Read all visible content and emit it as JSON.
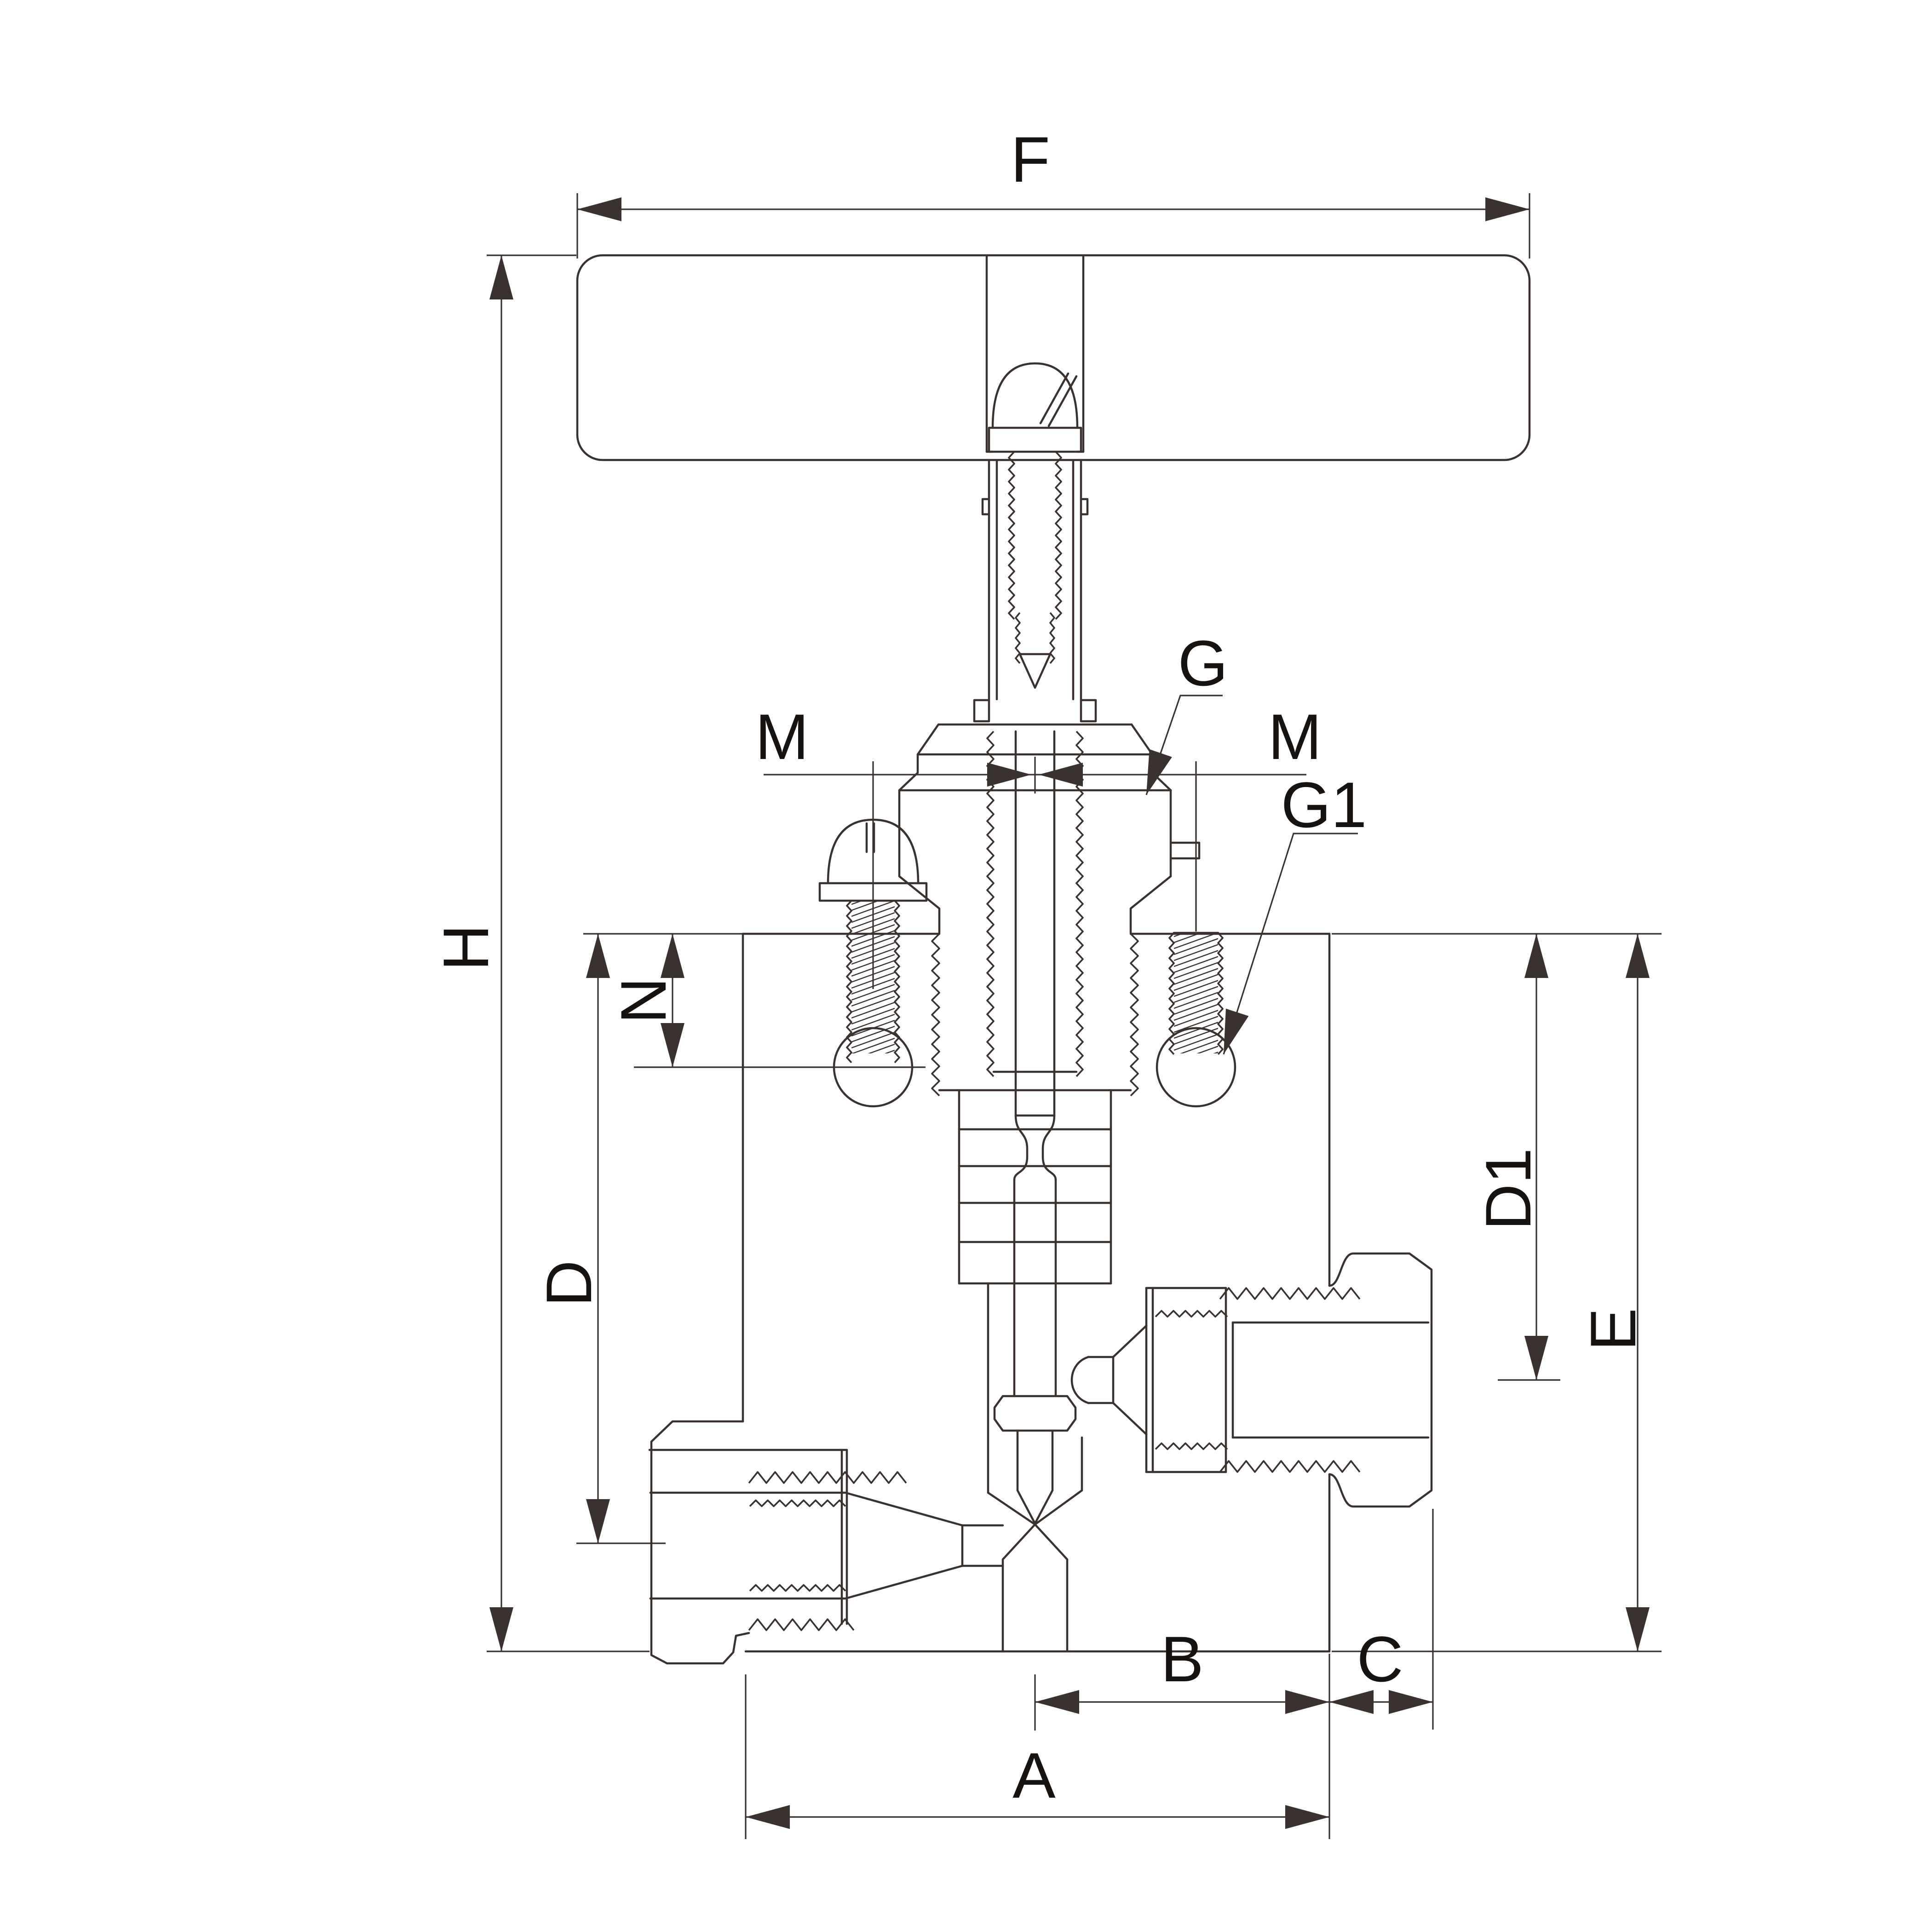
{
  "page": {
    "background": "#ffffff"
  },
  "drawing": {
    "kind": "valve-cross-section-technical-drawing",
    "line_color": "#3a322f",
    "label_color": "#171310",
    "labels": {
      "f": "F",
      "h": "H",
      "m_left": "M",
      "m_right": "M",
      "g": "G",
      "g1": "G1",
      "n": "N",
      "d": "D",
      "d1": "D1",
      "e": "E",
      "b": "B",
      "c": "C",
      "a": "A"
    }
  }
}
